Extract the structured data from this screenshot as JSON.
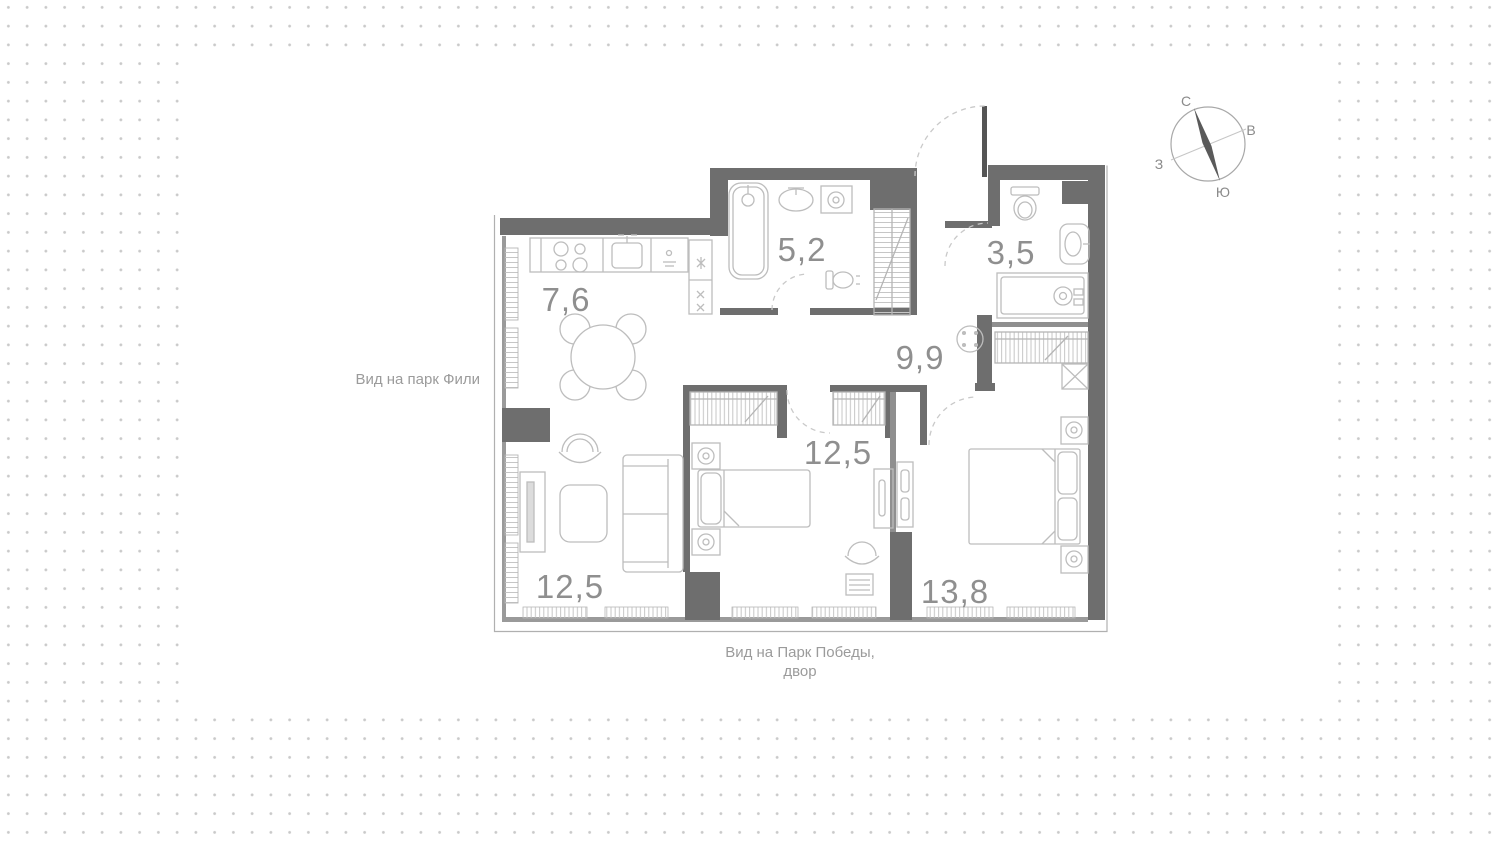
{
  "page": {
    "background": {
      "dot_color": "#c9c9c9",
      "card_color": "#ffffff"
    },
    "colors": {
      "wall": "#6e6e6e",
      "thin_wall": "#8f8f8f",
      "furniture_line": "#bdbdbd",
      "label": "#8f8f8f"
    }
  },
  "plan": {
    "rooms": [
      {
        "id": "kitchen",
        "area": "7,6"
      },
      {
        "id": "bathroom",
        "area": "5,2"
      },
      {
        "id": "wc",
        "area": "3,5"
      },
      {
        "id": "hallway",
        "area": "9,9"
      },
      {
        "id": "bedroom-middle",
        "area": "12,5"
      },
      {
        "id": "living-room",
        "area": "12,5"
      },
      {
        "id": "bedroom-right",
        "area": "13,8"
      }
    ],
    "views": {
      "left": "Вид на парк Фили",
      "bottom_line1": "Вид на Парк Победы,",
      "bottom_line2": "двор"
    },
    "compass": {
      "north": "С",
      "east": "В",
      "south": "Ю",
      "west": "З"
    }
  }
}
